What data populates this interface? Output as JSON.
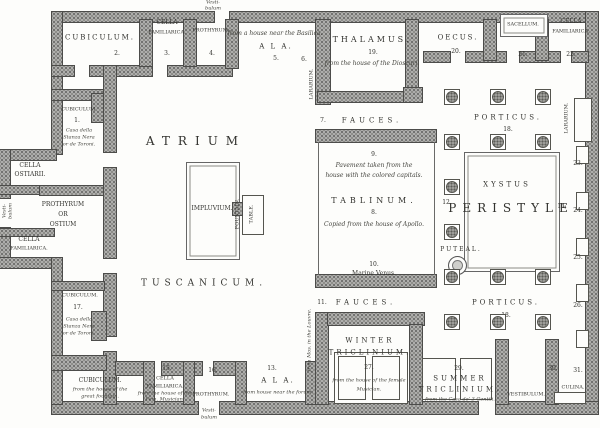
{
  "figure": {
    "kind": "floor-plan",
    "subject": "Plan of a Pompeian house model"
  },
  "colors": {
    "wall": "#aeaeac",
    "ink": "#33332f",
    "background": "#fdfdfb"
  },
  "labels": [
    {
      "name": "vestibulum-top-line1",
      "text": "Vesti-",
      "x": 213,
      "y": 3,
      "fs": 5,
      "it": 1
    },
    {
      "name": "vestibulum-top-line2",
      "text": "bulum",
      "x": 213,
      "y": 9,
      "fs": 5,
      "it": 1
    },
    {
      "name": "room-cubiculum-top",
      "text": "CUBICULUM.",
      "x": 100,
      "y": 38,
      "fs": 7,
      "ls": 2
    },
    {
      "name": "room-number-2",
      "text": "2.",
      "x": 117,
      "y": 54,
      "fs": 6
    },
    {
      "name": "room-cella-familiarica-top-line1",
      "text": "CELLA",
      "x": 167,
      "y": 23,
      "fs": 6
    },
    {
      "name": "room-cella-familiarica-top-line2",
      "text": "FAMILIARICA.",
      "x": 167,
      "y": 33,
      "fs": 5
    },
    {
      "name": "room-number-3",
      "text": "3.",
      "x": 167,
      "y": 54,
      "fs": 6
    },
    {
      "name": "room-prothyrum-top",
      "text": "PROTHYRUM.",
      "x": 211,
      "y": 31,
      "fs": 5
    },
    {
      "name": "room-number-4",
      "text": "4.",
      "x": 212,
      "y": 54,
      "fs": 6
    },
    {
      "name": "ala-top-source",
      "text": "from a house near the Basilica.",
      "x": 275,
      "y": 34,
      "fs": 6,
      "it": 1
    },
    {
      "name": "room-ala-top",
      "text": "A L A.",
      "x": 276,
      "y": 47,
      "fs": 7,
      "ls": 2
    },
    {
      "name": "room-number-5",
      "text": "5.",
      "x": 276,
      "y": 59,
      "fs": 6
    },
    {
      "name": "lararium-atrium",
      "text": "LARARIUM.",
      "x": 312,
      "y": 84,
      "fs": 5,
      "rot": 1
    },
    {
      "name": "room-number-6",
      "text": "6.",
      "x": 304,
      "y": 60,
      "fs": 6
    },
    {
      "name": "room-thalamus",
      "text": "THALAMUS.",
      "x": 372,
      "y": 40,
      "fs": 8,
      "ls": 3
    },
    {
      "name": "room-number-19",
      "text": "19.",
      "x": 373,
      "y": 53,
      "fs": 6
    },
    {
      "name": "thalamus-source",
      "text": "from the house of the Dioscuri.",
      "x": 372,
      "y": 64,
      "fs": 6,
      "it": 1
    },
    {
      "name": "room-oecus",
      "text": "OECUS.",
      "x": 458,
      "y": 38,
      "fs": 7,
      "ls": 2
    },
    {
      "name": "room-number-20",
      "text": "20.",
      "x": 456,
      "y": 52,
      "fs": 6
    },
    {
      "name": "sacellum",
      "text": "SACELLUM.",
      "x": 523,
      "y": 25,
      "fs": 5
    },
    {
      "name": "room-number-21",
      "text": "21.",
      "x": 523,
      "y": 55,
      "fs": 6
    },
    {
      "name": "room-cella-familiarica-right-line1",
      "text": "CELLA",
      "x": 571,
      "y": 22,
      "fs": 6
    },
    {
      "name": "room-cella-familiarica-right-line2",
      "text": "FAMILIARICA.",
      "x": 571,
      "y": 32,
      "fs": 5
    },
    {
      "name": "room-number-22",
      "text": "22.",
      "x": 571,
      "y": 55,
      "fs": 6
    },
    {
      "name": "room-porticus-top",
      "text": "PORTICUS.",
      "x": 508,
      "y": 118,
      "fs": 7,
      "ls": 3
    },
    {
      "name": "room-number-18-top",
      "text": "18.",
      "x": 508,
      "y": 130,
      "fs": 6
    },
    {
      "name": "lararium-peristyle",
      "text": "LARARIUM.",
      "x": 567,
      "y": 118,
      "fs": 5,
      "rot": 1
    },
    {
      "name": "room-number-23",
      "text": "23.",
      "x": 578,
      "y": 164,
      "fs": 6
    },
    {
      "name": "room-number-24",
      "text": "24.",
      "x": 578,
      "y": 211,
      "fs": 6
    },
    {
      "name": "room-number-25",
      "text": "25.",
      "x": 578,
      "y": 258,
      "fs": 6
    },
    {
      "name": "room-number-26",
      "text": "26.",
      "x": 578,
      "y": 306,
      "fs": 6
    },
    {
      "name": "xystus",
      "text": "XYSTUS",
      "x": 507,
      "y": 185,
      "fs": 7,
      "ls": 3
    },
    {
      "name": "room-peristyle",
      "text": "PERISTYLE",
      "x": 511,
      "y": 208,
      "fs": 12,
      "ls": 6
    },
    {
      "name": "room-number-12",
      "text": "12.",
      "x": 447,
      "y": 203,
      "fs": 6
    },
    {
      "name": "room-number-14",
      "text": "14.",
      "x": 562,
      "y": 207,
      "fs": 6
    },
    {
      "name": "puteal",
      "text": "PUTEAL.",
      "x": 461,
      "y": 250,
      "fs": 6,
      "ls": 2
    },
    {
      "name": "room-porticus-bottom",
      "text": "PORTICUS.",
      "x": 506,
      "y": 303,
      "fs": 7,
      "ls": 3
    },
    {
      "name": "room-number-18-bottom",
      "text": "18.",
      "x": 506,
      "y": 316,
      "fs": 6
    },
    {
      "name": "room-atrium",
      "text": "ATRIUM",
      "x": 196,
      "y": 141,
      "fs": 12,
      "ls": 8
    },
    {
      "name": "room-tuscanicum",
      "text": "TUSCANICUM.",
      "x": 204,
      "y": 284,
      "fs": 9,
      "ls": 5
    },
    {
      "name": "impluvium",
      "text": "IMPLUVIUM.",
      "x": 212,
      "y": 209,
      "fs": 6
    },
    {
      "name": "fountain",
      "text": "FOUNTAIN.",
      "x": 238,
      "y": 214,
      "fs": 5,
      "rot": 1
    },
    {
      "name": "table",
      "text": "TABLE.",
      "x": 252,
      "y": 214,
      "fs": 5,
      "rot": 1
    },
    {
      "name": "room-number-7",
      "text": "7.",
      "x": 323,
      "y": 121,
      "fs": 6
    },
    {
      "name": "room-fauces-top",
      "text": "FAUCES.",
      "x": 372,
      "y": 121,
      "fs": 7,
      "ls": 4
    },
    {
      "name": "room-number-9",
      "text": "9.",
      "x": 374,
      "y": 155,
      "fs": 6
    },
    {
      "name": "tablinum-source-line1",
      "text": "Pavement taken from the",
      "x": 374,
      "y": 166,
      "fs": 6,
      "it": 1
    },
    {
      "name": "tablinum-source-line2",
      "text": "house with the colored capitals.",
      "x": 374,
      "y": 176,
      "fs": 6,
      "it": 1
    },
    {
      "name": "room-tablinum",
      "text": "TABLINUM.",
      "x": 374,
      "y": 201,
      "fs": 8,
      "ls": 4
    },
    {
      "name": "room-number-8",
      "text": "8.",
      "x": 374,
      "y": 213,
      "fs": 6
    },
    {
      "name": "tablinum-source-line3",
      "text": "Copied from the house of Apollo.",
      "x": 374,
      "y": 225,
      "fs": 6,
      "it": 1
    },
    {
      "name": "room-number-10",
      "text": "10.",
      "x": 374,
      "y": 265,
      "fs": 6
    },
    {
      "name": "marine-venus",
      "text": "Marine Venus.",
      "x": 374,
      "y": 274,
      "fs": 6
    },
    {
      "name": "room-number-11",
      "text": "11.",
      "x": 322,
      "y": 303,
      "fs": 6
    },
    {
      "name": "room-fauces-bottom",
      "text": "FAUCES.",
      "x": 366,
      "y": 303,
      "fs": 7,
      "ls": 4
    },
    {
      "name": "louvre-note",
      "text": "from Mos. in the Louvre.",
      "x": 310,
      "y": 340,
      "fs": 5,
      "rot": 1,
      "it": 1
    },
    {
      "name": "room-winter-triclinium-line1",
      "text": "WINTER",
      "x": 370,
      "y": 341,
      "fs": 7,
      "ls": 3
    },
    {
      "name": "room-winter-triclinium-line2",
      "text": "TRICLINIUM.",
      "x": 370,
      "y": 353,
      "fs": 7,
      "ls": 3
    },
    {
      "name": "room-number-27",
      "text": "27.",
      "x": 369,
      "y": 368,
      "fs": 6
    },
    {
      "name": "winter-triclinium-source-line1",
      "text": "from the house of the female",
      "x": 369,
      "y": 381,
      "fs": 5,
      "it": 1
    },
    {
      "name": "winter-triclinium-source-line2",
      "text": "Musician.",
      "x": 369,
      "y": 390,
      "fs": 5,
      "it": 1
    },
    {
      "name": "room-number-29",
      "text": "29.",
      "x": 459,
      "y": 369,
      "fs": 6
    },
    {
      "name": "room-summer-triclinium-line1",
      "text": "SUMMER",
      "x": 460,
      "y": 379,
      "fs": 7,
      "ls": 3
    },
    {
      "name": "room-summer-triclinium-line2",
      "text": "TRICLINIUM.",
      "x": 460,
      "y": 390,
      "fs": 7,
      "ls": 3
    },
    {
      "name": "summer-triclinium-source",
      "text": "from the Casa de' 3 Gentili.",
      "x": 460,
      "y": 400,
      "fs": 5,
      "it": 1
    },
    {
      "name": "room-vestibulum-rear",
      "text": "VESTIBULUM.",
      "x": 526,
      "y": 395,
      "fs": 5
    },
    {
      "name": "room-number-30",
      "text": "30.",
      "x": 553,
      "y": 369,
      "fs": 6
    },
    {
      "name": "room-number-31",
      "text": "31.",
      "x": 578,
      "y": 371,
      "fs": 6
    },
    {
      "name": "room-culina",
      "text": "CULINA.",
      "x": 573,
      "y": 388,
      "fs": 5
    },
    {
      "name": "room-number-13",
      "text": "13.",
      "x": 272,
      "y": 369,
      "fs": 6
    },
    {
      "name": "room-ala-bottom",
      "text": "A L A.",
      "x": 278,
      "y": 381,
      "fs": 7,
      "ls": 2
    },
    {
      "name": "ala-bottom-source",
      "text": "from house near the forum.",
      "x": 278,
      "y": 393,
      "fs": 5,
      "it": 1
    },
    {
      "name": "room-number-16",
      "text": "16.",
      "x": 213,
      "y": 371,
      "fs": 6
    },
    {
      "name": "room-prothyrum-bottom",
      "text": "PROTHYRUM.",
      "x": 211,
      "y": 395,
      "fs": 5
    },
    {
      "name": "vestibulum-bottom-line1",
      "text": "Vesti-",
      "x": 209,
      "y": 411,
      "fs": 5,
      "it": 1
    },
    {
      "name": "vestibulum-bottom-line2",
      "text": "bulum",
      "x": 209,
      "y": 418,
      "fs": 5,
      "it": 1
    },
    {
      "name": "room-number-15",
      "text": "15.",
      "x": 167,
      "y": 369,
      "fs": 6
    },
    {
      "name": "room-cella-familiarica-bottom-line1",
      "text": "CELLA",
      "x": 165,
      "y": 379,
      "fs": 5
    },
    {
      "name": "room-cella-familiarica-bottom-line2",
      "text": "FAMILIARICA.",
      "x": 165,
      "y": 387,
      "fs": 5
    },
    {
      "name": "cella-familiarica-bottom-source-line1",
      "text": "from the house of the",
      "x": 165,
      "y": 394,
      "fs": 5,
      "it": 1
    },
    {
      "name": "cella-familiarica-bottom-source-line2",
      "text": "Fem. Musician.",
      "x": 165,
      "y": 400,
      "fs": 5,
      "it": 1
    },
    {
      "name": "room-cubiculum-bottom-left",
      "text": "CUBICULUM.",
      "x": 100,
      "y": 381,
      "fs": 6
    },
    {
      "name": "cubiculum-bottom-left-source-line1",
      "text": "from the house of the",
      "x": 100,
      "y": 390,
      "fs": 5,
      "it": 1
    },
    {
      "name": "cubiculum-bottom-left-source-line2",
      "text": "great fountain.",
      "x": 100,
      "y": 397,
      "fs": 5,
      "it": 1
    },
    {
      "name": "room-cubiculum-left-lower",
      "text": "CUBICULUM.",
      "x": 80,
      "y": 296,
      "fs": 5
    },
    {
      "name": "room-number-17",
      "text": "17.",
      "x": 78,
      "y": 308,
      "fs": 6
    },
    {
      "name": "cubiculum-17-source-line1",
      "text": "Casa della",
      "x": 79,
      "y": 320,
      "fs": 5,
      "it": 1
    },
    {
      "name": "cubiculum-17-source-line2",
      "text": "Stanza Nera",
      "x": 79,
      "y": 327,
      "fs": 5,
      "it": 1
    },
    {
      "name": "cubiculum-17-source-line3",
      "text": "or de Toroni.",
      "x": 79,
      "y": 334,
      "fs": 5,
      "it": 1
    },
    {
      "name": "room-cubiculum-left-upper",
      "text": "CUBICULUM.",
      "x": 79,
      "y": 110,
      "fs": 5
    },
    {
      "name": "room-number-1",
      "text": "1.",
      "x": 77,
      "y": 121,
      "fs": 6
    },
    {
      "name": "cubiculum-1-source-line1",
      "text": "Casa della",
      "x": 79,
      "y": 131,
      "fs": 5,
      "it": 1
    },
    {
      "name": "cubiculum-1-source-line2",
      "text": "Stanza Nera",
      "x": 79,
      "y": 138,
      "fs": 5,
      "it": 1
    },
    {
      "name": "cubiculum-1-source-line3",
      "text": "or de Toroni.",
      "x": 79,
      "y": 145,
      "fs": 5,
      "it": 1
    },
    {
      "name": "room-cella-ostiarii-line1",
      "text": "CELLA",
      "x": 30,
      "y": 166,
      "fs": 6
    },
    {
      "name": "room-cella-ostiarii-line2",
      "text": "OSTIARII.",
      "x": 30,
      "y": 175,
      "fs": 6
    },
    {
      "name": "room-prothyrum-or-ostium-line1",
      "text": "PROTHYRUM",
      "x": 63,
      "y": 205,
      "fs": 6
    },
    {
      "name": "room-prothyrum-or-ostium-line2",
      "text": "OR",
      "x": 63,
      "y": 215,
      "fs": 6
    },
    {
      "name": "room-prothyrum-or-ostium-line3",
      "text": "OSTIUM",
      "x": 63,
      "y": 225,
      "fs": 6
    },
    {
      "name": "vestibulum-left-line1",
      "text": "Vesti-",
      "x": 5,
      "y": 211,
      "fs": 5,
      "rot": 1,
      "it": 1
    },
    {
      "name": "vestibulum-left-line2",
      "text": "bulum",
      "x": 11,
      "y": 211,
      "fs": 5,
      "rot": 1,
      "it": 1
    },
    {
      "name": "room-cella-familiarica-left-line1",
      "text": "CELLA",
      "x": 29,
      "y": 240,
      "fs": 6
    },
    {
      "name": "room-cella-familiarica-left-line2",
      "text": "FAMILIARICA.",
      "x": 29,
      "y": 249,
      "fs": 5
    }
  ]
}
